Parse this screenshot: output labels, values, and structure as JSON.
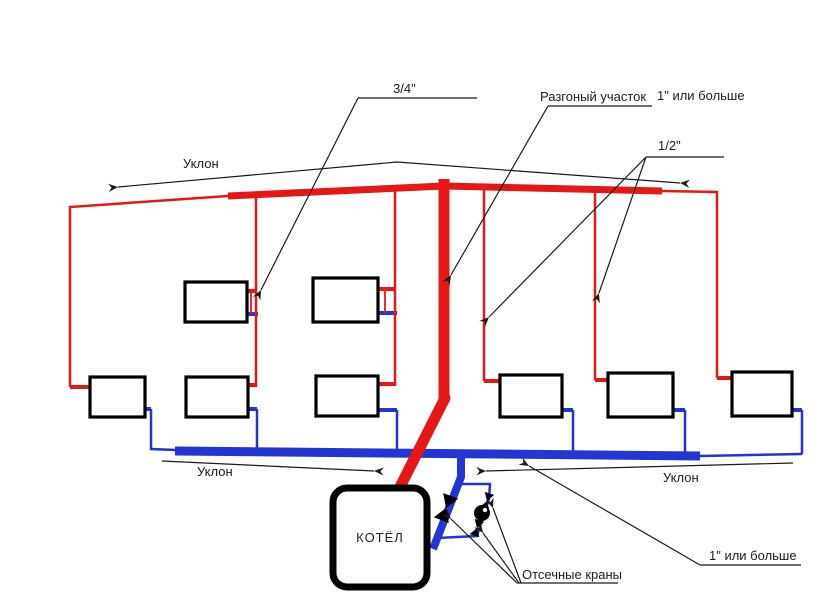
{
  "diagram_type": "single-pipe gravity heating system schematic",
  "colors": {
    "supply_pipe": "#e51717",
    "return_pipe": "#2435d4",
    "outline": "#000000",
    "leader_line": "#1a1a1a",
    "background": "#ffffff"
  },
  "labels": {
    "pipe_three_quarter": "3/4\"",
    "accel_section": "Разгоный участок",
    "one_inch_or_more_top": "1\" или больше",
    "half_inch": "1/2\"",
    "slope_top": "Уклон",
    "slope_bottom_left": "Уклон",
    "slope_bottom_right": "Уклон",
    "one_inch_or_more_bottom": "1\" или больше",
    "shutoff_valves": "Отсечные краны",
    "boiler": "КОТЁЛ"
  },
  "components": {
    "boiler_count": 1,
    "radiator_count": 8,
    "shutoff_valve_count": 3,
    "pump_count": 1,
    "icons": [
      "valve-icon",
      "pump-icon",
      "arrowhead-icon"
    ]
  }
}
